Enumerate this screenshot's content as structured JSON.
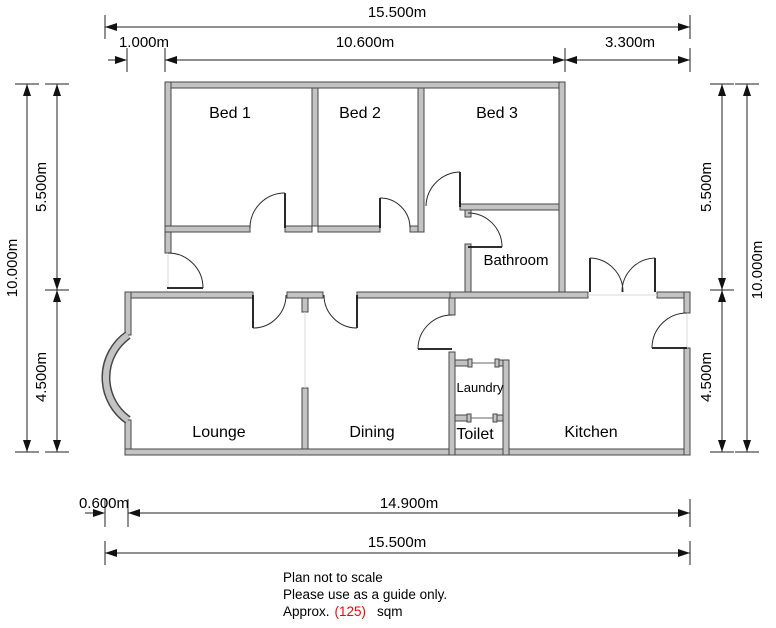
{
  "plan": {
    "rooms": {
      "bed1": "Bed 1",
      "bed2": "Bed 2",
      "bed3": "Bed 3",
      "bathroom": "Bathroom",
      "lounge": "Lounge",
      "dining": "Dining",
      "laundry": "Laundry",
      "toilet": "Toilet",
      "kitchen": "Kitchen"
    },
    "dims": {
      "top_total": "15.500m",
      "top_left_offset": "1.000m",
      "top_mid": "10.600m",
      "top_right": "3.300m",
      "left_outer": "10.000m",
      "left_upper": "5.500m",
      "left_lower": "4.500m",
      "right_upper": "5.500m",
      "right_outer": "10.000m",
      "right_lower": "4.500m",
      "bottom_offset": "0.600m",
      "bottom_main": "14.900m",
      "bottom_total": "15.500m"
    },
    "notes": {
      "line1": "Plan not to scale",
      "line2": "Please use as a guide only.",
      "approx_prefix": "Approx.",
      "approx_value": "(125)",
      "approx_suffix": "sqm"
    },
    "colors": {
      "wall_fill": "#c3c3c3",
      "wall_edge": "#474747",
      "line": "#222222",
      "accent_red": "#ff0000",
      "background": "#ffffff"
    }
  }
}
